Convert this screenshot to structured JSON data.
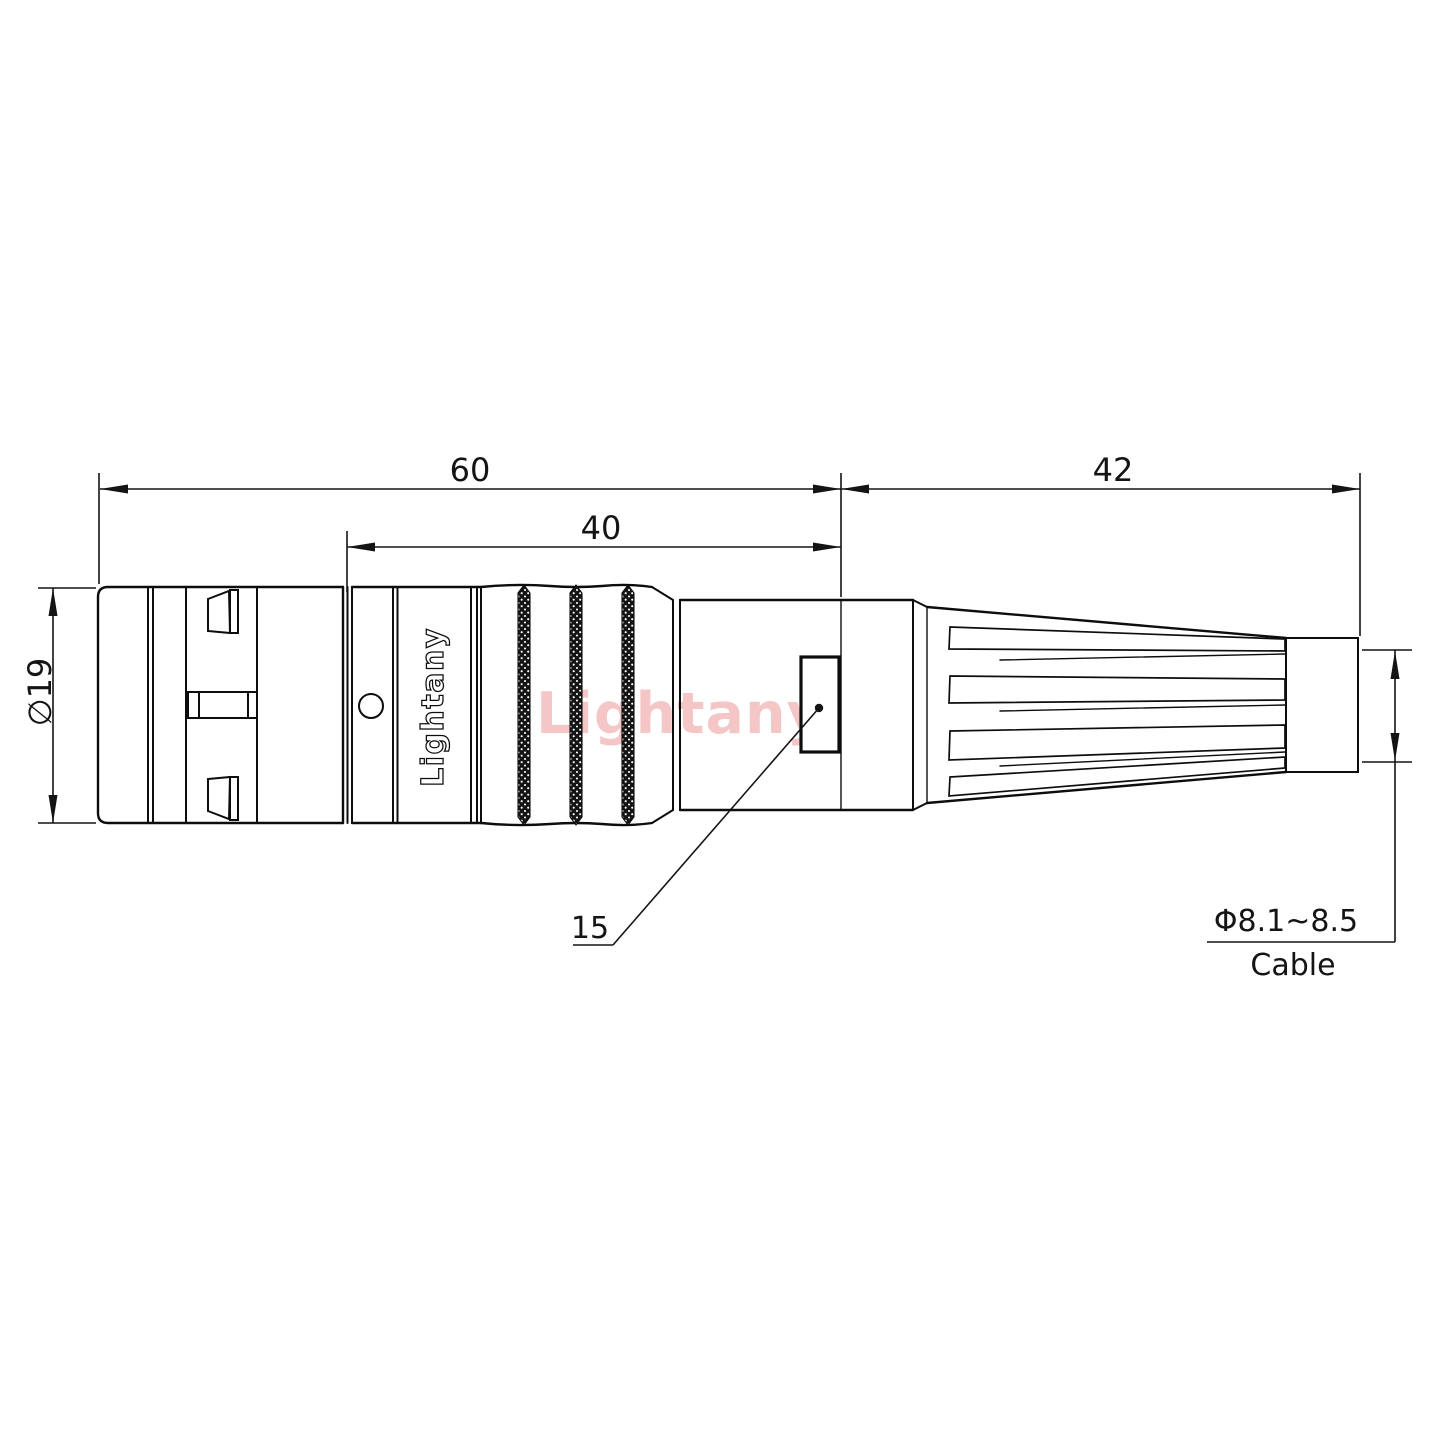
{
  "drawing": {
    "watermark": "Lightany",
    "body_logo": "Lightany",
    "dimensions": {
      "front_length": "60",
      "mid_length": "40",
      "rear_length": "42",
      "body_diameter": "∅19",
      "detail_ref": "15",
      "cable_diameter": "Φ8.1~8.5",
      "cable_label": "Cable"
    },
    "colors": {
      "line": "#0d0d0d",
      "watermark": "#f4c6c6",
      "background": "#ffffff"
    }
  }
}
